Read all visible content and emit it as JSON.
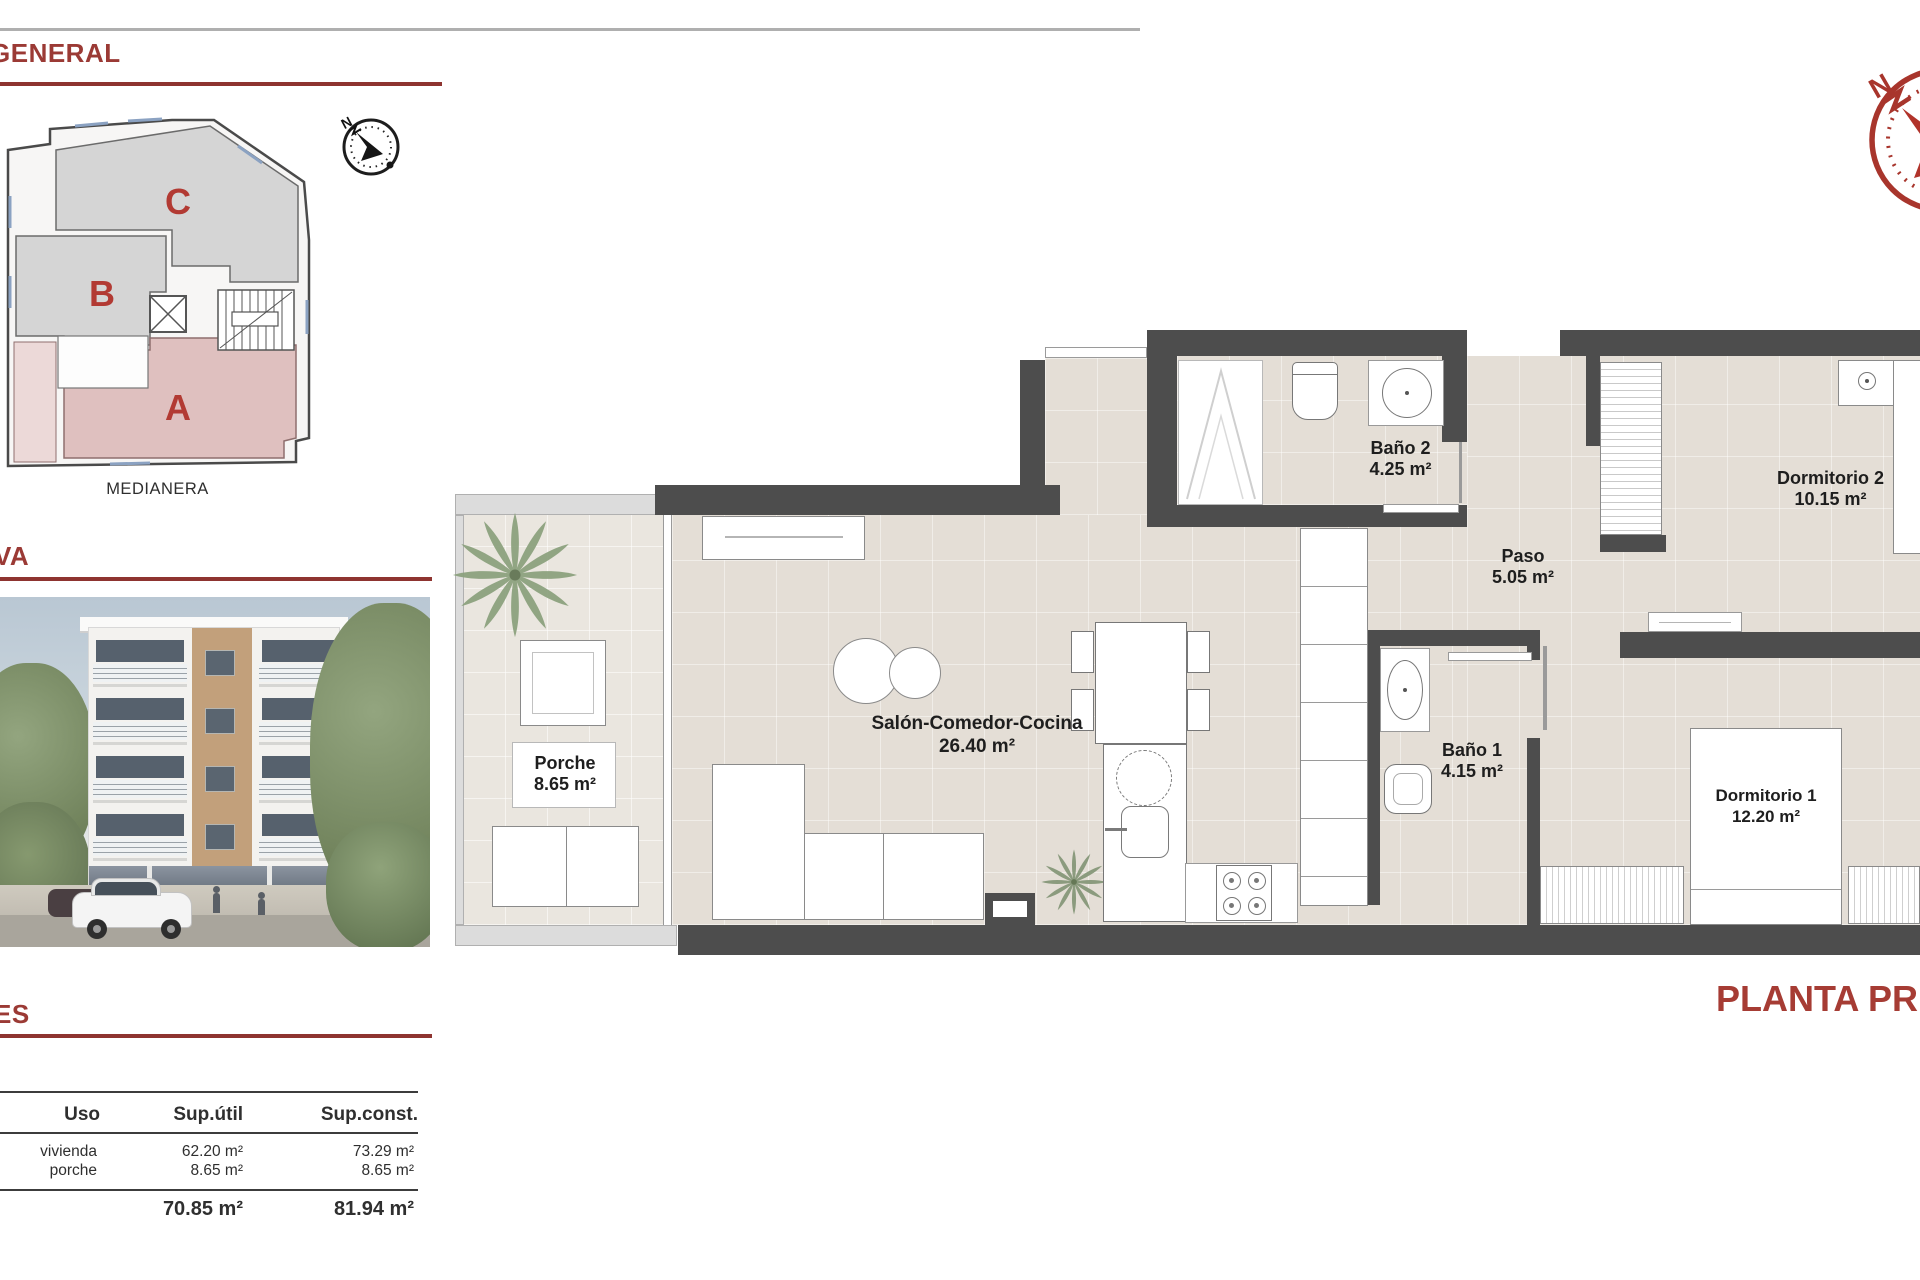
{
  "document": {
    "headings": {
      "general": "GENERAL",
      "perspectiva": "VA",
      "superficies": "ES"
    },
    "site_plan": {
      "labels": {
        "a": "A",
        "b": "B",
        "c": "C"
      },
      "caption": "MEDIANERA"
    },
    "areas_table": {
      "headers": [
        "Uso",
        "Sup.útil",
        "Sup.const."
      ],
      "rows": [
        {
          "uso": "vivienda",
          "util": "62.20 m²",
          "constr": "73.29 m²"
        },
        {
          "uso": "porche",
          "util": "8.65 m²",
          "constr": "8.65 m²"
        }
      ],
      "totals": {
        "util": "70.85 m²",
        "constr": "81.94 m²"
      }
    },
    "floorplan": {
      "title": "PLANTA PRIMERA",
      "compass_north": "N",
      "rooms": {
        "porche": {
          "name": "Porche",
          "area": "8.65 m²"
        },
        "salon": {
          "name": "Salón-Comedor-Cocina",
          "area": "26.40 m²"
        },
        "bano2": {
          "name": "Baño 2",
          "area": "4.25 m²"
        },
        "paso": {
          "name": "Paso",
          "area": "5.05 m²"
        },
        "dormitorio2": {
          "name": "Dormitorio 2",
          "area": "10.15 m²"
        },
        "bano1": {
          "name": "Baño 1",
          "area": "4.15 m²"
        },
        "dormitorio1": {
          "name": "Dormitorio 1",
          "area": "12.20 m²"
        }
      }
    },
    "colors": {
      "accent": "#9b3a35",
      "plan_title": "#a63c34",
      "wall": "#4d4d4d",
      "tile": "#e4ded6",
      "section_pink": "#dfc0bf",
      "section_gray": "#d5d5d5",
      "compass_red": "#a8352c"
    }
  }
}
